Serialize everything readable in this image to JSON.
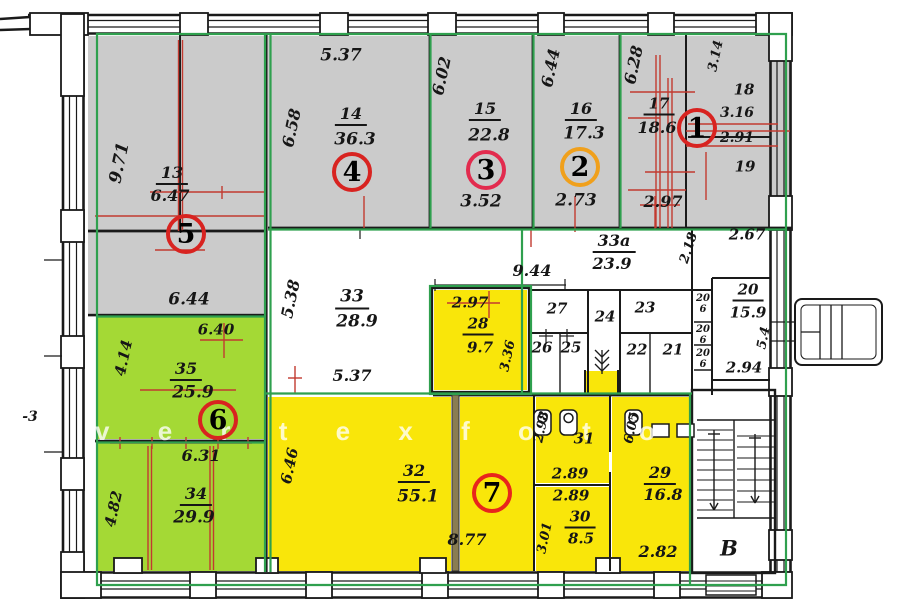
{
  "meta": {
    "type": "apartment-floor-plan-scan",
    "watermark": "vertexfoto",
    "stairwell_letter": "В",
    "outside_note": "-3"
  },
  "colors": {
    "gray_zone": "#cbcbcb",
    "green_zone": "#a4d935",
    "yellow_zone": "#f9e60a",
    "boundary_green": "#2fa04e",
    "red_line": "#c23a30",
    "wall": "#1a1a1a",
    "ring_red": "#d82320",
    "ring_orange": "#f0a01c"
  },
  "apartments": [
    {
      "num": "1",
      "x": 697,
      "y": 128,
      "ring": "#d82320"
    },
    {
      "num": "2",
      "x": 580,
      "y": 167,
      "ring": "#f0a01c"
    },
    {
      "num": "3",
      "x": 486,
      "y": 170,
      "ring": "#e22b4e"
    },
    {
      "num": "4",
      "x": 352,
      "y": 172,
      "ring": "#d82320"
    },
    {
      "num": "5",
      "x": 186,
      "y": 234,
      "ring": "#d82320"
    },
    {
      "num": "6",
      "x": 218,
      "y": 420,
      "ring": "#d82320"
    },
    {
      "num": "7",
      "x": 492,
      "y": 493,
      "ring": "#e8251c"
    }
  ],
  "labels": [
    {
      "k": "dim",
      "t": "9.71",
      "x": 120,
      "y": 163,
      "r": -78,
      "s": 17
    },
    {
      "k": "room",
      "t": "13",
      "x": 172,
      "y": 175,
      "s": 16,
      "u": 1
    },
    {
      "k": "area",
      "t": "6.47",
      "x": 170,
      "y": 196,
      "s": 16
    },
    {
      "k": "dim",
      "t": "5.37",
      "x": 341,
      "y": 56,
      "s": 17
    },
    {
      "k": "dim",
      "t": "6.58",
      "x": 292,
      "y": 128,
      "r": -78,
      "s": 16
    },
    {
      "k": "room",
      "t": "14",
      "x": 351,
      "y": 116,
      "s": 16,
      "u": 1
    },
    {
      "k": "area",
      "t": "36.3",
      "x": 355,
      "y": 140,
      "s": 17
    },
    {
      "k": "dim",
      "t": "6.02",
      "x": 442,
      "y": 76,
      "r": -78,
      "s": 16
    },
    {
      "k": "room",
      "t": "15",
      "x": 485,
      "y": 111,
      "s": 16,
      "u": 1
    },
    {
      "k": "area",
      "t": "22.8",
      "x": 489,
      "y": 136,
      "s": 17
    },
    {
      "k": "dim",
      "t": "3.52",
      "x": 481,
      "y": 202,
      "s": 17
    },
    {
      "k": "dim",
      "t": "6.44",
      "x": 551,
      "y": 68,
      "r": -78,
      "s": 16
    },
    {
      "k": "room",
      "t": "16",
      "x": 581,
      "y": 111,
      "s": 16,
      "u": 1
    },
    {
      "k": "area",
      "t": "17.3",
      "x": 584,
      "y": 134,
      "s": 17
    },
    {
      "k": "dim",
      "t": "2.73",
      "x": 576,
      "y": 201,
      "s": 17
    },
    {
      "k": "dim",
      "t": "6.28",
      "x": 634,
      "y": 65,
      "r": -78,
      "s": 16
    },
    {
      "k": "dim",
      "t": "3.14",
      "x": 716,
      "y": 56,
      "r": -78,
      "s": 13
    },
    {
      "k": "room",
      "t": "17",
      "x": 659,
      "y": 106,
      "s": 15,
      "u": 1
    },
    {
      "k": "area",
      "t": "18.6",
      "x": 657,
      "y": 128,
      "s": 16
    },
    {
      "k": "room",
      "t": "18",
      "x": 744,
      "y": 90,
      "s": 15
    },
    {
      "k": "dim",
      "t": "3.16",
      "x": 737,
      "y": 113,
      "s": 14
    },
    {
      "k": "dim",
      "t": "2.91",
      "x": 737,
      "y": 138,
      "s": 14
    },
    {
      "k": "room",
      "t": "19",
      "x": 745,
      "y": 167,
      "s": 15
    },
    {
      "k": "dim",
      "t": "2.97",
      "x": 663,
      "y": 202,
      "s": 16
    },
    {
      "k": "dim",
      "t": "6.44",
      "x": 189,
      "y": 300,
      "s": 17
    },
    {
      "k": "dim",
      "t": "5.38",
      "x": 291,
      "y": 299,
      "r": -78,
      "s": 16
    },
    {
      "k": "room",
      "t": "33",
      "x": 352,
      "y": 299,
      "s": 17,
      "u": 1
    },
    {
      "k": "area",
      "t": "28.9",
      "x": 357,
      "y": 322,
      "s": 17
    },
    {
      "k": "dim",
      "t": "5.37",
      "x": 352,
      "y": 376,
      "s": 16
    },
    {
      "k": "dim",
      "t": "9.44",
      "x": 532,
      "y": 271,
      "s": 16
    },
    {
      "k": "room",
      "t": "33а",
      "x": 614,
      "y": 243,
      "s": 16,
      "u": 1
    },
    {
      "k": "area",
      "t": "23.9",
      "x": 612,
      "y": 264,
      "s": 16
    },
    {
      "k": "dim",
      "t": "2.18",
      "x": 689,
      "y": 248,
      "r": -72,
      "s": 13
    },
    {
      "k": "dim",
      "t": "2.67",
      "x": 747,
      "y": 235,
      "s": 15
    },
    {
      "k": "room",
      "t": "27",
      "x": 557,
      "y": 309,
      "s": 15
    },
    {
      "k": "room",
      "t": "26",
      "x": 542,
      "y": 348,
      "s": 15
    },
    {
      "k": "room",
      "t": "25",
      "x": 571,
      "y": 348,
      "s": 15
    },
    {
      "k": "room",
      "t": "24",
      "x": 605,
      "y": 317,
      "s": 15
    },
    {
      "k": "room",
      "t": "23",
      "x": 645,
      "y": 308,
      "s": 15
    },
    {
      "k": "room",
      "t": "22",
      "x": 637,
      "y": 350,
      "s": 15
    },
    {
      "k": "room",
      "t": "21",
      "x": 673,
      "y": 350,
      "s": 15
    },
    {
      "k": "room",
      "t": "20",
      "x": 703,
      "y": 299,
      "s": 10
    },
    {
      "k": "area",
      "t": "6",
      "x": 703,
      "y": 310,
      "s": 10
    },
    {
      "k": "room",
      "t": "20",
      "x": 703,
      "y": 330,
      "s": 10
    },
    {
      "k": "area",
      "t": "6",
      "x": 703,
      "y": 341,
      "s": 10
    },
    {
      "k": "room",
      "t": "20",
      "x": 703,
      "y": 354,
      "s": 10
    },
    {
      "k": "area",
      "t": "6",
      "x": 703,
      "y": 365,
      "s": 10
    },
    {
      "k": "room",
      "t": "20",
      "x": 748,
      "y": 292,
      "s": 15,
      "u": 1
    },
    {
      "k": "area",
      "t": "15.9",
      "x": 748,
      "y": 313,
      "s": 15
    },
    {
      "k": "dim",
      "t": "5.4",
      "x": 764,
      "y": 338,
      "r": -78,
      "s": 13
    },
    {
      "k": "dim",
      "t": "2.94",
      "x": 744,
      "y": 368,
      "s": 15
    },
    {
      "k": "dim",
      "t": "6.40",
      "x": 216,
      "y": 330,
      "s": 15
    },
    {
      "k": "dim",
      "t": "4.14",
      "x": 124,
      "y": 358,
      "r": -78,
      "s": 15
    },
    {
      "k": "room",
      "t": "35",
      "x": 186,
      "y": 371,
      "s": 16,
      "u": 1
    },
    {
      "k": "area",
      "t": "25.9",
      "x": 193,
      "y": 393,
      "s": 17
    },
    {
      "k": "dim",
      "t": "6.31",
      "x": 201,
      "y": 456,
      "s": 16
    },
    {
      "k": "dim",
      "t": "4.82",
      "x": 114,
      "y": 509,
      "r": -78,
      "s": 15
    },
    {
      "k": "room",
      "t": "34",
      "x": 196,
      "y": 496,
      "s": 16,
      "u": 1
    },
    {
      "k": "area",
      "t": "29.9",
      "x": 194,
      "y": 518,
      "s": 17
    },
    {
      "k": "dim",
      "t": "2.97",
      "x": 470,
      "y": 303,
      "s": 15
    },
    {
      "k": "room",
      "t": "28",
      "x": 478,
      "y": 326,
      "s": 15,
      "u": 1
    },
    {
      "k": "area",
      "t": "9.7",
      "x": 480,
      "y": 348,
      "s": 15
    },
    {
      "k": "dim",
      "t": "3.36",
      "x": 508,
      "y": 356,
      "r": -78,
      "s": 13
    },
    {
      "k": "dim",
      "t": "6.46",
      "x": 290,
      "y": 466,
      "r": -78,
      "s": 15
    },
    {
      "k": "room",
      "t": "32",
      "x": 414,
      "y": 473,
      "s": 16,
      "u": 1
    },
    {
      "k": "area",
      "t": "55.1",
      "x": 418,
      "y": 497,
      "s": 17
    },
    {
      "k": "dim",
      "t": "8.77",
      "x": 467,
      "y": 540,
      "s": 16
    },
    {
      "k": "dim",
      "t": "2.98",
      "x": 542,
      "y": 427,
      "r": -78,
      "s": 13
    },
    {
      "k": "room",
      "t": "31",
      "x": 584,
      "y": 439,
      "s": 15
    },
    {
      "k": "dim",
      "t": "2.89",
      "x": 570,
      "y": 474,
      "s": 15
    },
    {
      "k": "dim",
      "t": "2.89",
      "x": 571,
      "y": 496,
      "s": 15
    },
    {
      "k": "room",
      "t": "30",
      "x": 580,
      "y": 519,
      "s": 15,
      "u": 1
    },
    {
      "k": "area",
      "t": "8.5",
      "x": 581,
      "y": 539,
      "s": 15
    },
    {
      "k": "dim",
      "t": "3.01",
      "x": 545,
      "y": 538,
      "r": -78,
      "s": 13
    },
    {
      "k": "dim",
      "t": "6.05",
      "x": 632,
      "y": 428,
      "r": -78,
      "s": 13
    },
    {
      "k": "room",
      "t": "29",
      "x": 660,
      "y": 475,
      "s": 16,
      "u": 1
    },
    {
      "k": "area",
      "t": "16.8",
      "x": 663,
      "y": 495,
      "s": 16
    },
    {
      "k": "dim",
      "t": "2.82",
      "x": 658,
      "y": 552,
      "s": 16
    },
    {
      "k": "note",
      "t": "В",
      "x": 729,
      "y": 548,
      "s": 21
    },
    {
      "k": "note",
      "t": "-3",
      "x": 30,
      "y": 417,
      "s": 14
    }
  ]
}
